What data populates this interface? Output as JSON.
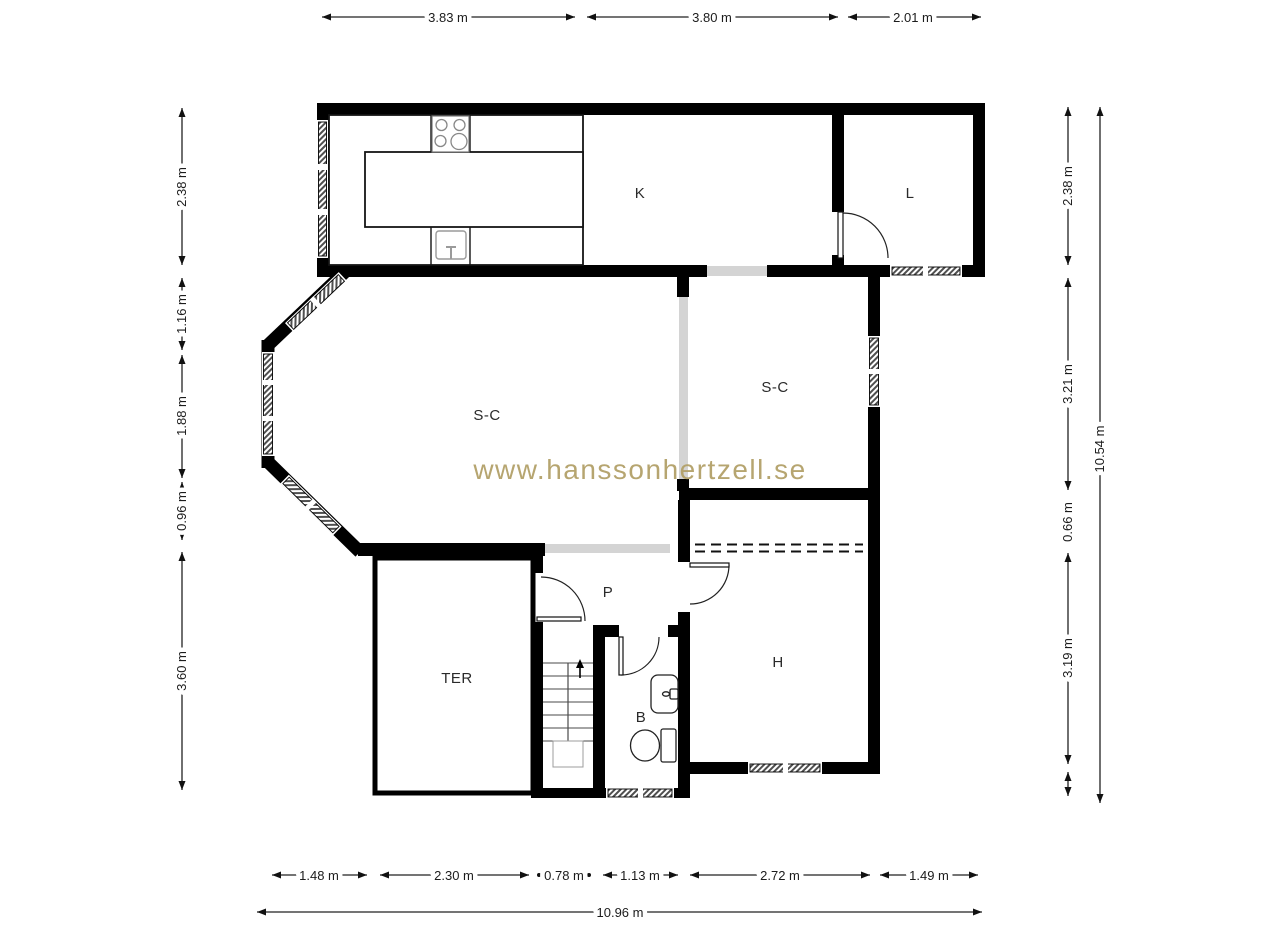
{
  "watermark": "www.hanssonhertzell.se",
  "colors": {
    "watermark": "#b3a169",
    "wall": "#000000",
    "opening_gray": "#d4d4d4"
  },
  "rooms": {
    "kitchen": "K",
    "living": "L",
    "sc_left": "S-C",
    "sc_right": "S-C",
    "passage": "P",
    "terrace": "TER",
    "bath": "B",
    "hall": "H"
  },
  "dimensions": {
    "top": [
      "3.83 m",
      "3.80 m",
      "2.01 m"
    ],
    "bottom": [
      "1.48 m",
      "2.30 m",
      "0.78 m",
      "1.13 m",
      "2.72 m",
      "1.49 m"
    ],
    "bottom_total": "10.96 m",
    "left": [
      "2.38 m",
      "1.16 m",
      "1.88 m",
      "0.96 m",
      "3.60 m"
    ],
    "right": [
      "2.38 m",
      "3.21 m",
      "0.66 m",
      "3.19 m"
    ],
    "right_total": "10.54 m"
  }
}
